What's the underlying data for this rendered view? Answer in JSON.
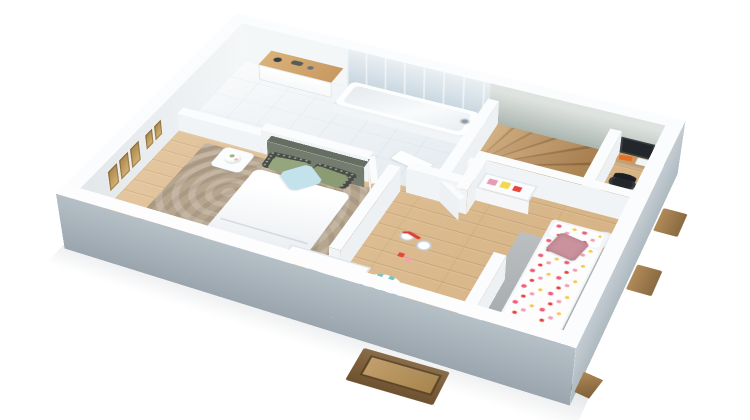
{
  "scene": {
    "type": "3d-floorplan-render",
    "description": "Isometric 3D rendering of an upper-storey floor plan on a white background, with bathroom, master bedroom, hallway, winding staircase, desk nook and children's bedroom",
    "view": "cutaway dollhouse view from above"
  },
  "rooms": [
    {
      "name": "bathroom",
      "furniture": [
        "bathtub",
        "wall-faucet",
        "floating-vanity",
        "vanity-accessories",
        "tiled-floor",
        "blue-tile-wall",
        "floor-towel"
      ]
    },
    {
      "name": "master-bedroom",
      "furniture": [
        "double-bed",
        "dark-headboard",
        "patterned-pillows",
        "sage-pillows",
        "blue-pillow",
        "nightstand-with-flowers",
        "wall-frames",
        "patterned-rug",
        "storage-bench-with-books"
      ]
    },
    {
      "name": "hallway",
      "furniture": [
        "open-door-bathroom",
        "open-door-kids-room",
        "tricycle",
        "striped-pouf",
        "bottom-dormer-window"
      ]
    },
    {
      "name": "staircase",
      "furniture": [
        "winder-stairs",
        "white-fascia"
      ]
    },
    {
      "name": "desk-nook",
      "furniture": [
        "wood-desk",
        "monitor",
        "orange-book",
        "white-printer",
        "desk-chair"
      ]
    },
    {
      "name": "kids-bedroom",
      "furniture": [
        "single-bed-heart-duvet",
        "heart-pillow",
        "pink-cushion",
        "toy-shelf",
        "waste-bin",
        "grey-rug",
        "small-toys",
        "side-dormer-windows"
      ]
    }
  ],
  "palette": {
    "background": "#ffffff",
    "wall-top": "#fbfcfd",
    "wall-interior": "#f1f4f6",
    "wall-exterior-dark": "#9aa5ae",
    "wall-exterior-light": "#c3ccd2",
    "accent-wall-green": "#b4beb8",
    "tile-blue": "#cdd9e2",
    "tile-floor": "#eef2f5",
    "wood-floor": "#debc8e",
    "stair-wood": "#c09a66",
    "rug-master": "#b7a68f",
    "rug-kids": "#a9aeb0",
    "headboard": "#666d62",
    "pillow-blue": "#c3e2ec",
    "pillow-sage": "#95a67e",
    "kids-heart-pink": "#ee5f7a",
    "kids-cushion": "#c9929c",
    "toy-yellow": "#f2d84b",
    "toy-blue": "#7fc4d8",
    "book-orange": "#e2702a",
    "pouf-teal": "#6fc7c5",
    "tricycle-red": "#e03c31",
    "dormer-wood": "#8a6a42"
  }
}
